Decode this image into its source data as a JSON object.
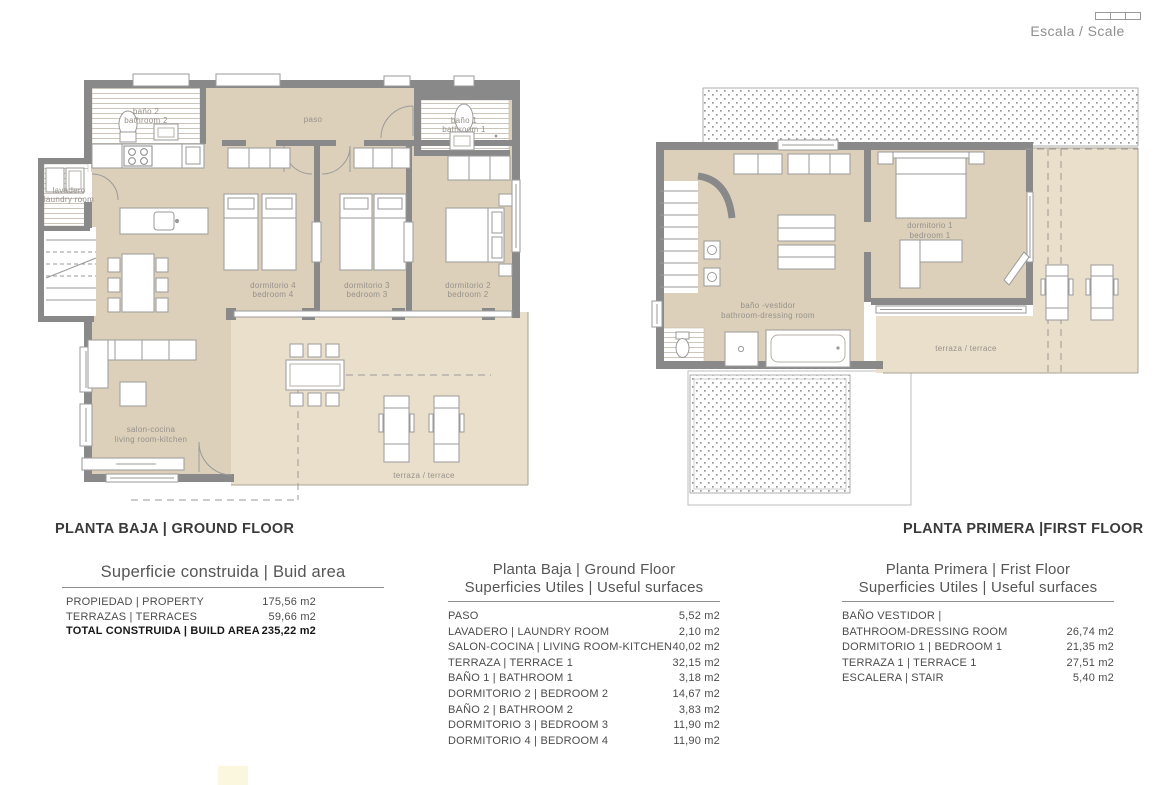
{
  "scale": {
    "label": "Escala / Scale"
  },
  "colors": {
    "wall": "#898989",
    "interior": "#dcd0bb",
    "terrace": "#eadfca",
    "label_text": "#96918a"
  },
  "plans": {
    "ground": {
      "title": "PLANTA BAJA | GROUND FLOOR",
      "labels": {
        "bano2": [
          "baño 2",
          "bathroom 2"
        ],
        "lavadero": [
          "lavadero",
          "laundry room"
        ],
        "paso": "paso",
        "bano1": [
          "baño 1",
          "bathroom 1"
        ],
        "dorm4": [
          "dormitorio 4",
          "bedroom 4"
        ],
        "dorm3": [
          "dormitorio 3",
          "bedroom 3"
        ],
        "dorm2": [
          "dormitorio 2",
          "bedroom 2"
        ],
        "salon": [
          "salon-cocina",
          "living room-kitchen"
        ],
        "terrace": "terraza / terrace"
      }
    },
    "first": {
      "title": "PLANTA PRIMERA |FIRST FLOOR",
      "labels": {
        "bath_dressing": [
          "baño -vestidor",
          "bathroom-dressing room"
        ],
        "dorm1": [
          "dormitorio 1",
          "bedroom 1"
        ],
        "terrace": "terraza / terrace"
      }
    }
  },
  "tables": {
    "summary": {
      "title": "Superficie construida | Buid area",
      "rows": [
        {
          "label": "PROPIEDAD | PROPERTY",
          "value": "175,56 m2"
        },
        {
          "label": "TERRAZAS | TERRACES",
          "value": "59,66 m2"
        },
        {
          "label": "TOTAL CONSTRUIDA | BUILD AREA",
          "value": "235,22 m2"
        }
      ]
    },
    "ground": {
      "title1": "Planta Baja | Ground Floor",
      "title2": "Superficies Utiles | Useful surfaces",
      "rows": [
        {
          "label": "PASO",
          "value": "5,52 m2"
        },
        {
          "label": "LAVADERO | LAUNDRY ROOM",
          "value": "2,10 m2"
        },
        {
          "label": "SALON-COCINA | LIVING ROOM-KITCHEN",
          "value": "40,02 m2"
        },
        {
          "label": "TERRAZA | TERRACE 1",
          "value": "32,15 m2"
        },
        {
          "label": "BAÑO 1 | BATHROOM 1",
          "value": "3,18 m2"
        },
        {
          "label": "DORMITORIO 2 | BEDROOM 2",
          "value": "14,67 m2"
        },
        {
          "label": "BAÑO 2 | BATHROOM 2",
          "value": "3,83 m2"
        },
        {
          "label": "DORMITORIO 3 | BEDROOM 3",
          "value": "11,90 m2"
        },
        {
          "label": "DORMITORIO 4 | BEDROOM 4",
          "value": "11,90 m2"
        }
      ]
    },
    "first": {
      "title1": "Planta Primera | Frist Floor",
      "title2": "Superficies Utiles | Useful surfaces",
      "rows": [
        {
          "label": "BAÑO VESTIDOR |",
          "value": ""
        },
        {
          "label": "BATHROOM-DRESSING ROOM",
          "value": "26,74 m2"
        },
        {
          "label": "DORMITORIO 1 | BEDROOM 1",
          "value": "21,35 m2"
        },
        {
          "label": "TERRAZA 1 | TERRACE 1",
          "value": "27,51 m2"
        },
        {
          "label": "ESCALERA | STAIR",
          "value": "5,40 m2"
        }
      ]
    }
  }
}
